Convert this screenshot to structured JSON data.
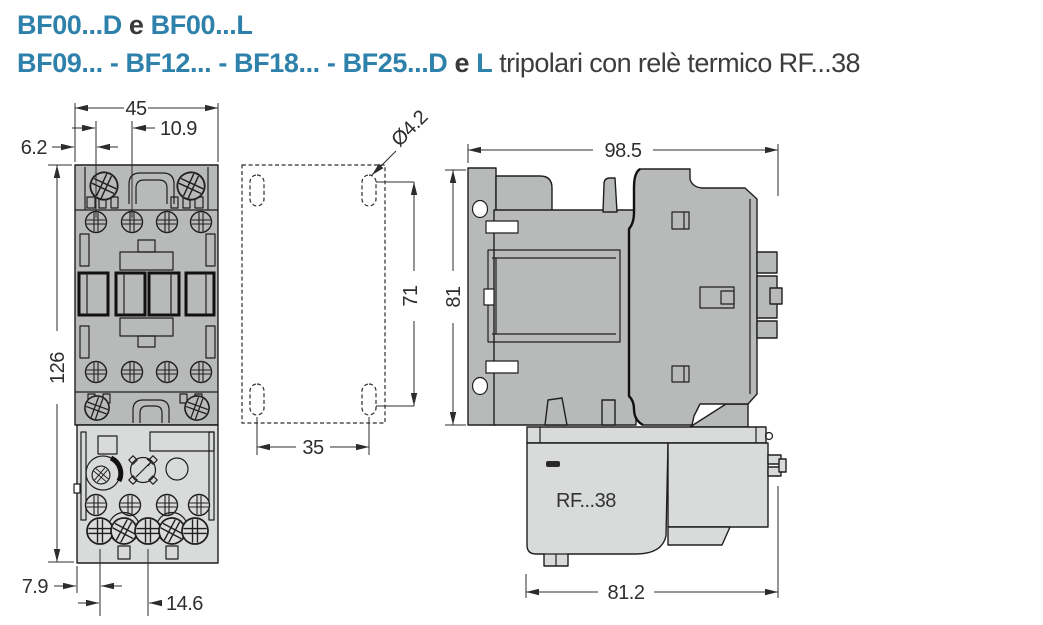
{
  "title": {
    "line1": {
      "part1": "BF00...D",
      "conj": " e ",
      "part2": "BF00...L"
    },
    "line2": {
      "part1": "BF09... - BF12... - BF18... - BF25...D",
      "conj": " e ",
      "part2": "L",
      "tail": " tripolari con relè termico RF...38"
    }
  },
  "dims": {
    "front": {
      "overall_width": "45",
      "pole_pitch": "10.9",
      "edge_to_first_pole": "6.2",
      "overall_height": "126",
      "relay_edge_offset": "7.9",
      "relay_terminal_pitch": "14.6"
    },
    "mounting": {
      "hole_diameter": "Ø4.2",
      "hole_spacing_vertical": "71",
      "hole_spacing_horizontal": "35"
    },
    "side": {
      "overall_depth": "98.5",
      "overall_height": "81",
      "relay_depth": "81.2",
      "relay_label": "RF...38"
    }
  },
  "colors": {
    "accent_blue": "#2e81ab",
    "contactor_gray": "#b8bab9",
    "relay_gray": "#d9dbda",
    "line_dark": "#1f1f1f"
  }
}
